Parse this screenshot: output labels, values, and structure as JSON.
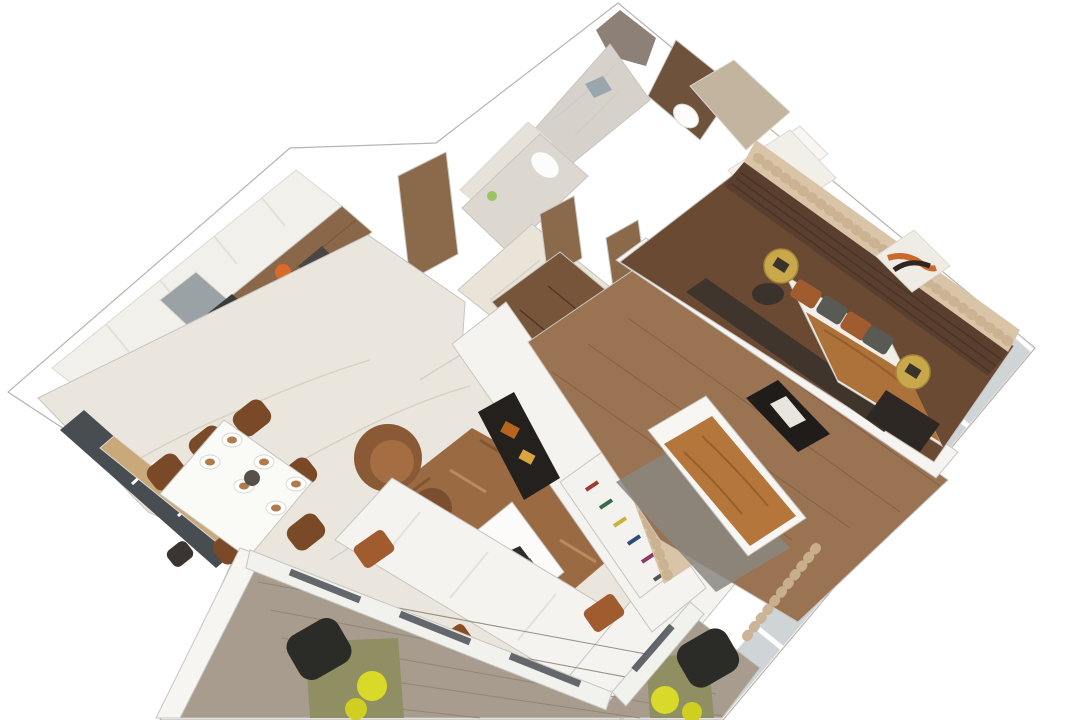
{
  "scene": {
    "type": "3d-floorplan-render",
    "description": "Isometric cutaway 3D rendering of a two-bedroom apartment floor plan on a white background",
    "rooms": {
      "kitchen": {
        "label": "Kitchen",
        "items": [
          "white upper cabinets",
          "wood lower cabinets",
          "fridge",
          "cooktop",
          "oven",
          "fruit bowl"
        ]
      },
      "dining": {
        "label": "Dining area",
        "items": [
          "white dining table",
          "plates",
          "six brown chairs",
          "window bench"
        ]
      },
      "living": {
        "label": "Living room",
        "items": [
          "white L-shaped sofa",
          "brown rug",
          "white coffee table",
          "brown armchair",
          "bookshelf",
          "TV partition"
        ]
      },
      "master_bedroom": {
        "label": "Master bedroom",
        "items": [
          "double bed",
          "wood slat headboard wall",
          "artwork",
          "gold side tables",
          "bench",
          "curtains"
        ]
      },
      "second_bedroom": {
        "label": "Second bedroom",
        "items": [
          "bed with caramel blanket",
          "gray rug",
          "wall art",
          "wardrobe",
          "curtains"
        ]
      },
      "bathroom_marble": {
        "label": "Bathroom with marble shower",
        "items": [
          "shower",
          "toilet"
        ]
      },
      "bathroom_brown": {
        "label": "Bathroom with brown tile",
        "items": [
          "toilet",
          "vanity"
        ]
      },
      "hallway": {
        "label": "Hallway",
        "items": [
          "wooden doors",
          "marble floor",
          "entry wardrobe"
        ]
      },
      "balcony": {
        "label": "Balcony",
        "items": [
          "plank floor",
          "black wicker chairs",
          "olive mats",
          "yellow poufs"
        ]
      }
    }
  },
  "colors": {
    "background": "#ffffff",
    "outline_band": "#fbfbfa",
    "band_edge": "#b8b5b0",
    "taupe_wall": "#8d8177",
    "bath_marble": "#d6d2cb",
    "bath_marble_wall": "#e6e2da",
    "bath1b_floor": "#dcd7cf",
    "drain": "#9aa5ad",
    "toilet_white": "#fcfcfa",
    "bottle_green": "#9bc464",
    "bath2_brown": "#6e523c",
    "beige_wall": "#c3b4a0",
    "vanity_white": "#f8f6f2",
    "wardrobe_white": "#f2efe9",
    "door_wood": "#8a6a4a",
    "hall_marble": "#e9e3d8",
    "entry_wardrobe_wood": "#76553a",
    "kitchen_upper": "#f2f0ea",
    "kitchen_wood": "#8a6748",
    "fridge_gray": "#9aa2a6",
    "cooktop_dark": "#3a3a38",
    "oven_dark": "#4a4644",
    "pot_gray": "#c9c9c9",
    "fruit_orange": "#d96a2a",
    "window_dark": "#484d52",
    "sill_tan": "#c9a87a",
    "marble_floor": "#eae5dd",
    "table_white": "#fafaf7",
    "plate_white": "#ffffff",
    "plate_food": "#b07a4a",
    "centerpiece": "#565049",
    "chair_brown": "#7a4a28",
    "stool_dark": "#3c3430",
    "rug_brown": "#9a6a42",
    "rug_dark": "#7a4e2c",
    "rug_light": "#c79a6a",
    "armchair_brown": "#8a5a36",
    "ottoman_brown": "#7a4e2e",
    "coffee_table": "#fcfbf9",
    "magazine_dark": "#2e2a28",
    "magazine_gray": "#55514c",
    "sofa_white": "#f4f3ef",
    "pillow_rust": "#a05c2e",
    "pillow_rust_dark": "#8a4a22",
    "shelf_white": "#f4f2ee",
    "book_red": "#a03a2e",
    "book_green": "#3a6a4a",
    "book_yellow": "#c9b23a",
    "book_blue": "#2e4a7a",
    "book_purple": "#8a3a6a",
    "book_gray": "#555550",
    "partition_white": "#f5f3ef",
    "tv_dark": "#23201e",
    "tv_art1": "#b5651d",
    "tv_art2": "#d9a441",
    "curtain_beige": "#d9c4a8",
    "bed2_floor_wood": "#9a7352",
    "divider_white": "#f6f4f0",
    "frame_dark": "#1f1c1a",
    "art_figure": "#e8e5df",
    "bed_white": "#f7f6f2",
    "blanket_caramel": "#b5763c",
    "rug2_gray": "#8a877f",
    "master_floor_wood": "#6b4a34",
    "slat_wall": "#5a3f2e",
    "art_frame": "#efece6",
    "art_orange": "#c96a2a",
    "art_dark": "#30261f",
    "gold": "#c8a84b",
    "gold_dark": "#a5863a",
    "plant_dark": "#3a332c",
    "bedspread_caramel": "#ad713a",
    "mattress_white": "#f2efe8",
    "pillow_gray": "#5a5a55",
    "bench_dark": "#2e2824",
    "console_dark": "#3f352c",
    "glass_band": "#cfd4d7",
    "balcony_floor": "#a89c8e",
    "balcony_wall": "#f6f5f2",
    "mat_olive": "#8f8f63",
    "pouf_yellow": "#d9d929",
    "pouf_yellow2": "#cfcf22",
    "wicker_black": "#2b2b28",
    "door_band": "#f1f1ee"
  }
}
